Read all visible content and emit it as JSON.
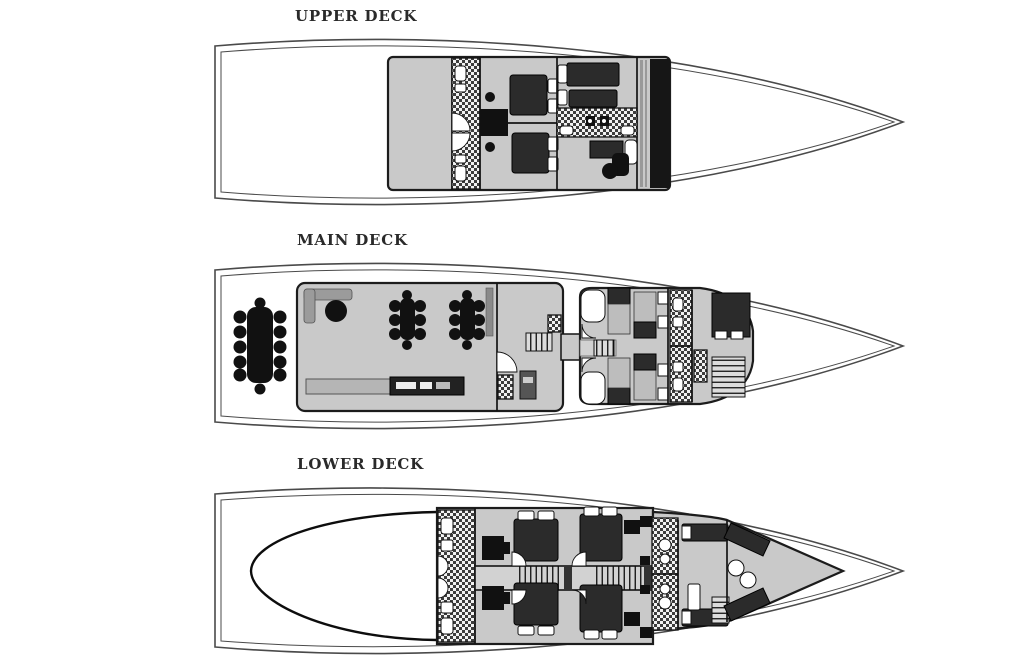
{
  "diagram": {
    "type": "yacht-deck-plan",
    "decks": [
      {
        "id": "upper-deck",
        "label": "UPPER DECK"
      },
      {
        "id": "main-deck",
        "label": "MAIN DECK"
      },
      {
        "id": "lower-deck",
        "label": "LOWER DECK"
      }
    ]
  },
  "colors": {
    "background": "#ffffff",
    "outline": "#1c1c1c",
    "hullline": "#4a4a4a",
    "structure": "#c9c9c9",
    "corridor": "#d2d2d2",
    "dark": "#2b2b2b",
    "black": "#111111",
    "bargray": "#9b9b9b",
    "bedbody": "#bdbdbd",
    "white": "#ffffff",
    "stairbg": "#dcdcdc"
  }
}
